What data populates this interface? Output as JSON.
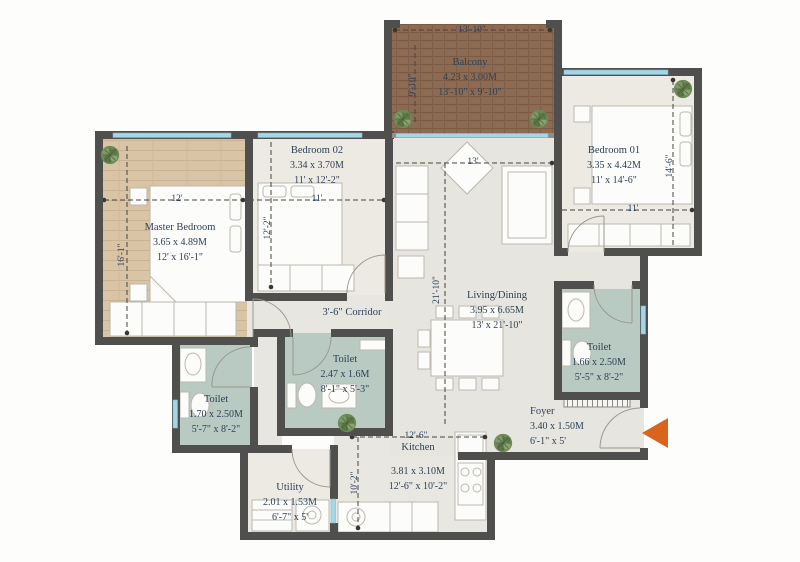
{
  "rooms": {
    "balcony": {
      "name": "Balcony",
      "metric": "4.23 x 3.00M",
      "imperial": "13'-10\" x 9'-10\""
    },
    "bedroom02": {
      "name": "Bedroom 02",
      "metric": "3.34 x 3.70M",
      "imperial": "11' x 12'-2\""
    },
    "bedroom01": {
      "name": "Bedroom 01",
      "metric": "3.35 x 4.42M",
      "imperial": "11' x 14'-6\""
    },
    "master": {
      "name": "Master Bedroom",
      "metric": "3.65 x 4.89M",
      "imperial": "12' x 16'-1\""
    },
    "living": {
      "name": "Living/Dining",
      "metric": "3.95 x 6.65M",
      "imperial": "13' x 21'-10\""
    },
    "toilet_center": {
      "name": "Toilet",
      "metric": "2.47 x 1.6M",
      "imperial": "8'-1\" x 5'-3\""
    },
    "toilet_right": {
      "name": "Toilet",
      "metric": "1.66 x 2.50M",
      "imperial": "5'-5\" x 8'-2\""
    },
    "toilet_left": {
      "name": "Toilet",
      "metric": "1.70 x 2.50M",
      "imperial": "5'-7\" x 8'-2\""
    },
    "kitchen": {
      "name": "Kitchen",
      "metric": "3.81 x 3.10M",
      "imperial": "12'-6\" x 10'-2\""
    },
    "utility": {
      "name": "Utility",
      "metric": "2.01 x 1.53M",
      "imperial": "6'-7\" x 5'"
    },
    "foyer": {
      "name": "Foyer",
      "metric": "3.40 x 1.50M",
      "imperial": "6'-1\" x 5'"
    },
    "corridor": {
      "name": "3'-6\" Corridor"
    }
  },
  "dimensions": {
    "balcony_width": "13'-10\"",
    "balcony_depth": "9'-10\"",
    "master_width": "12'",
    "master_length": "16'-1\"",
    "bedroom02_width": "11'",
    "bedroom02_length": "12'-2\"",
    "living_width": "13'",
    "living_length": "21'-10\"",
    "bedroom01_width": "11'",
    "bedroom01_length": "14'-6\"",
    "kitchen_width": "12'-6\"",
    "kitchen_length": "10'-2\""
  },
  "icons": {
    "plant": "plant-icon",
    "entry_arrow": "entry-arrow-icon"
  },
  "colors": {
    "wall": "#4f4f4d",
    "window": "#a5d6e6",
    "toilet_floor": "#b9cac2",
    "bedroom_floor": "#edeae3",
    "hall_floor": "#e7e5e0",
    "master_wood": "#d9c5a6",
    "balcony_wood": "#8d6b53",
    "label_text": "#2e4156",
    "entry_arrow": "#d9641e"
  }
}
